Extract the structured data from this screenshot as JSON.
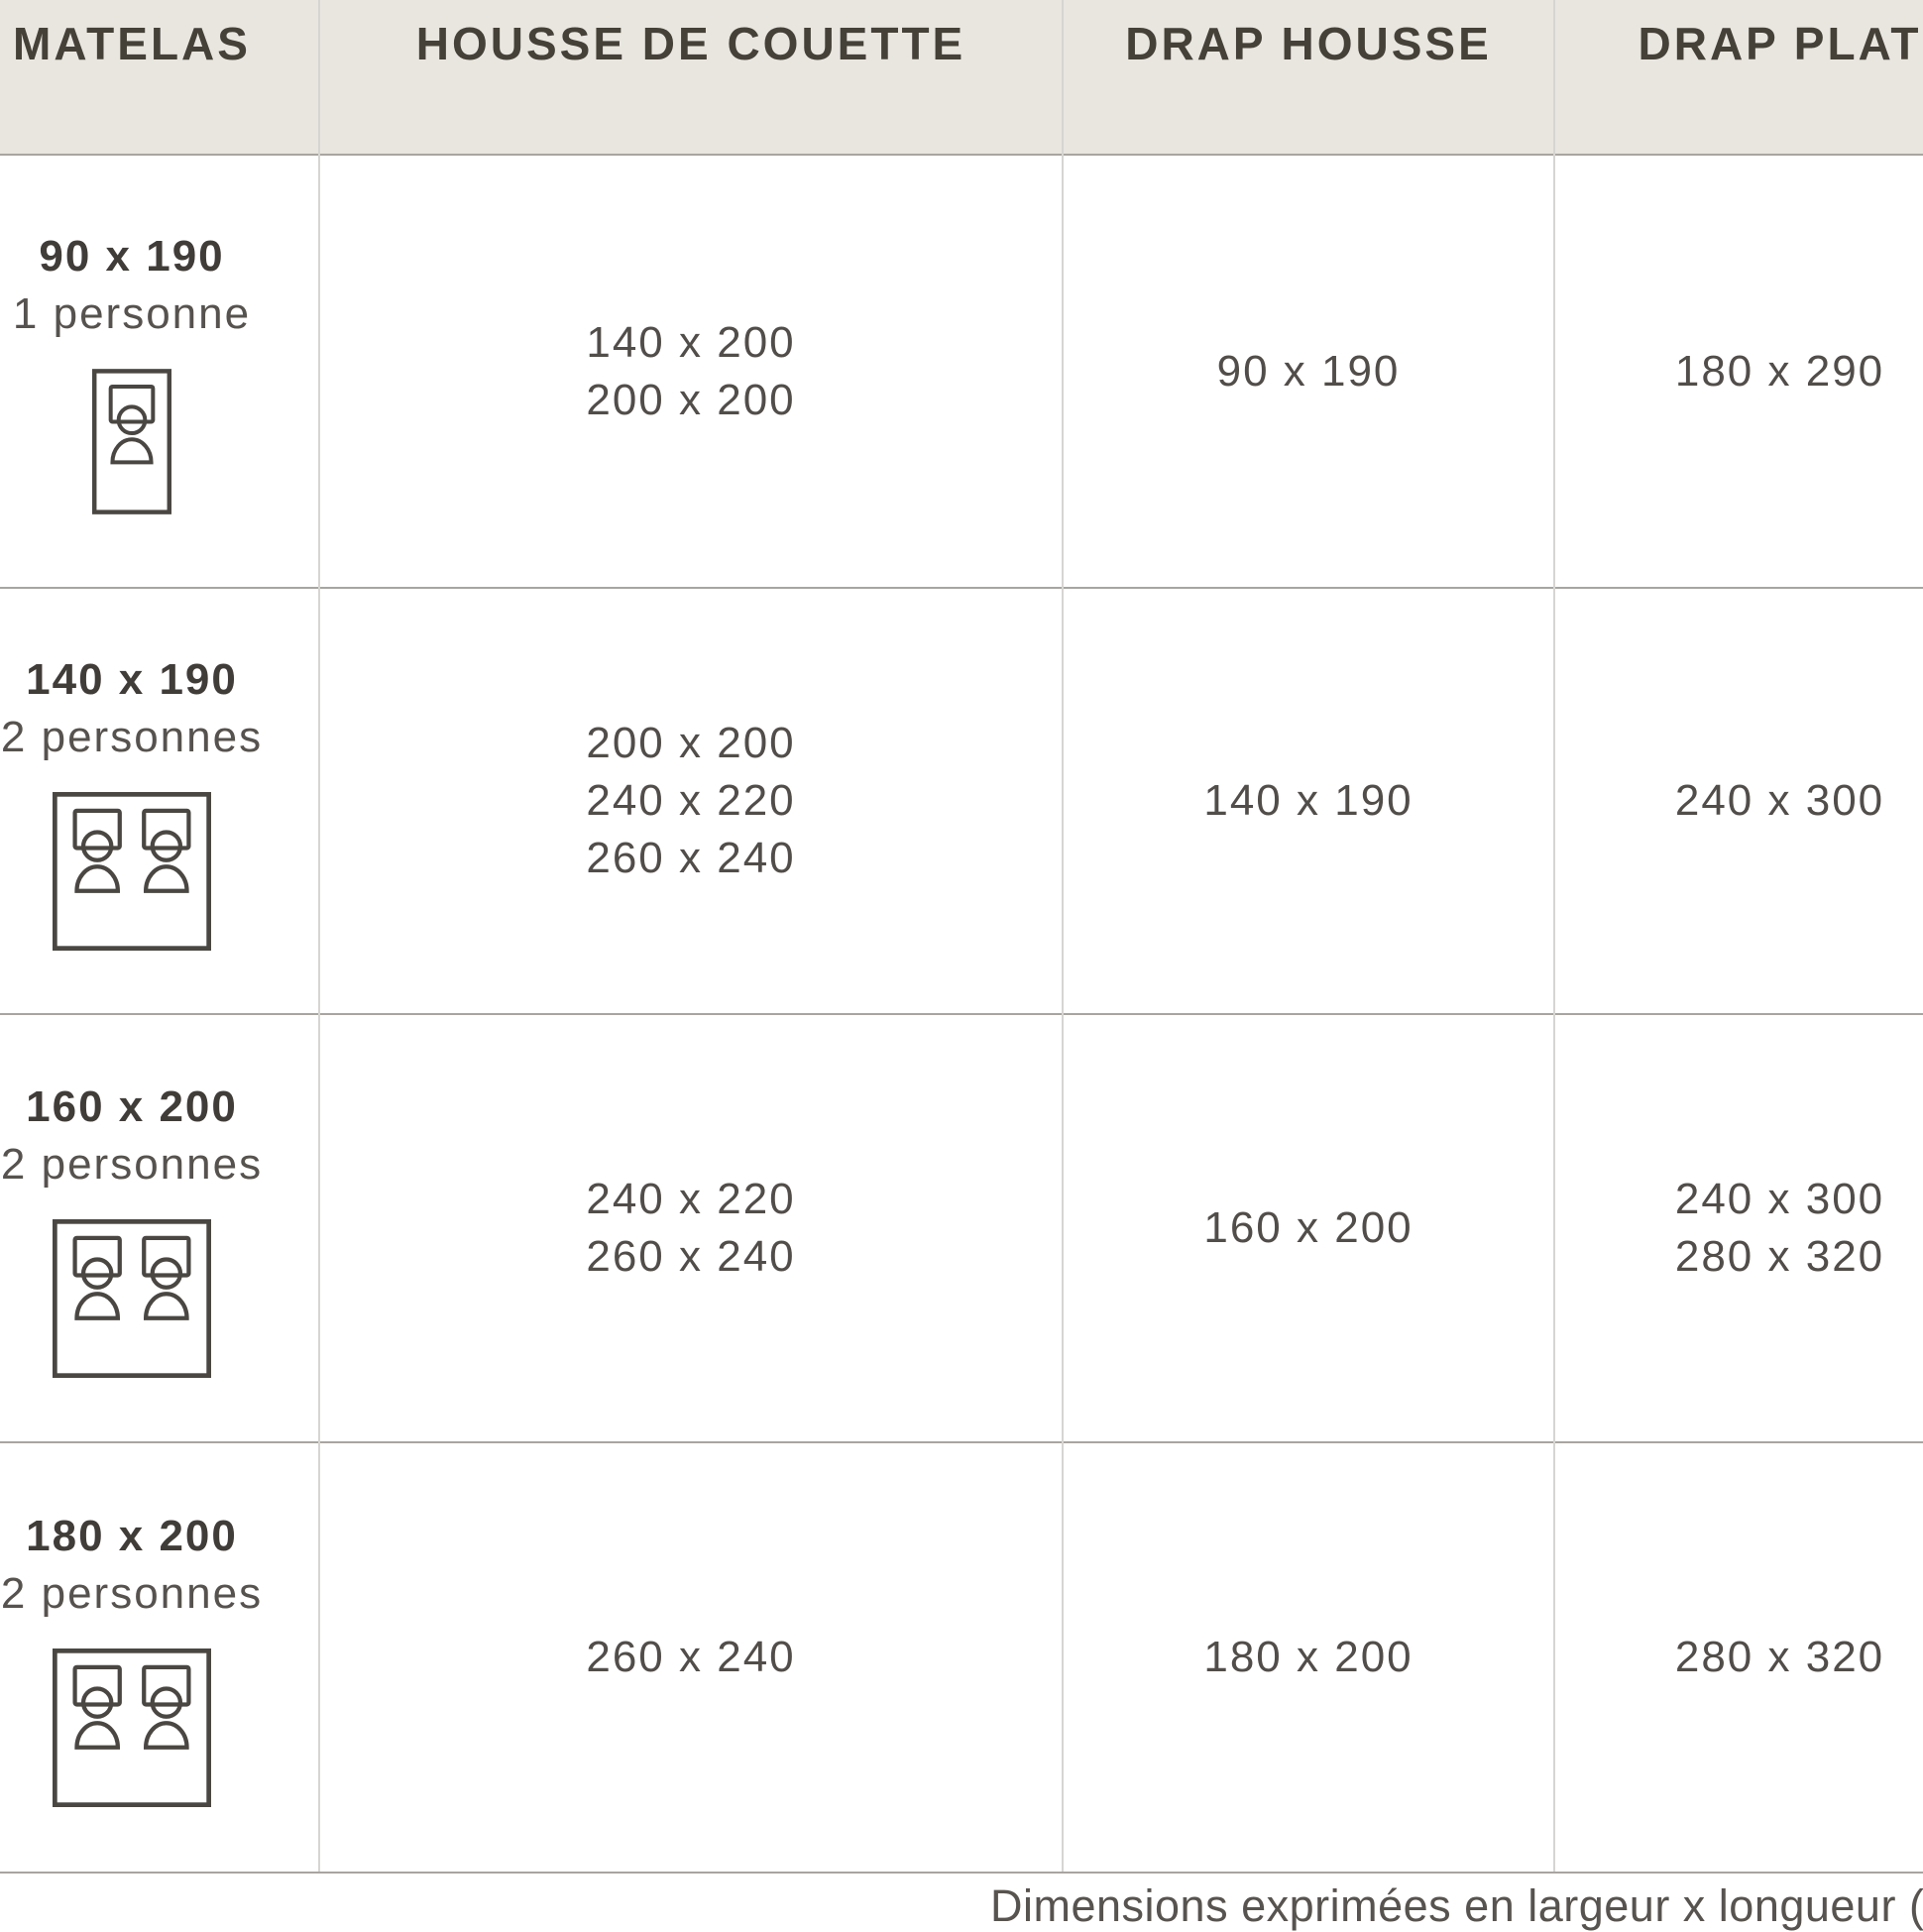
{
  "chart_data": {
    "type": "table",
    "columns": [
      "MATELAS",
      "HOUSSE DE COUETTE",
      "DRAP HOUSSE",
      "DRAP PLAT"
    ],
    "rows": [
      {
        "mattress_size": "90 x 190",
        "persons": "1 personne",
        "bed_icon": "single-bed-icon",
        "housse_de_couette": [
          "140 x 200",
          "200 x 200"
        ],
        "drap_housse": [
          "90 x 190"
        ],
        "drap_plat": [
          "180 x 290"
        ]
      },
      {
        "mattress_size": "140 x 190",
        "persons": "2 personnes",
        "bed_icon": "double-bed-icon",
        "housse_de_couette": [
          "200 x 200",
          "240 x 220",
          "260 x 240"
        ],
        "drap_housse": [
          "140 x 190"
        ],
        "drap_plat": [
          "240 x 300"
        ]
      },
      {
        "mattress_size": "160 x 200",
        "persons": "2 personnes",
        "bed_icon": "double-bed-icon",
        "housse_de_couette": [
          "240 x 220",
          "260 x 240"
        ],
        "drap_housse": [
          "160 x 200"
        ],
        "drap_plat": [
          "240 x 300",
          "280 x 320"
        ]
      },
      {
        "mattress_size": "180 x 200",
        "persons": "2 personnes",
        "bed_icon": "double-bed-icon",
        "housse_de_couette": [
          "260 x 240"
        ],
        "drap_housse": [
          "180 x 200"
        ],
        "drap_plat": [
          "280 x 320"
        ]
      }
    ],
    "footnote": "Dimensions exprimées en largeur x longueur (cm"
  },
  "colors": {
    "header_bg": "#e9e6e0",
    "header_text": "#454139",
    "bold_text": "#403c38",
    "body_text": "#514d49",
    "row_line": "#a8a5a1",
    "column_line": "#d7d5d1",
    "icon_stroke": "#4a4742"
  }
}
